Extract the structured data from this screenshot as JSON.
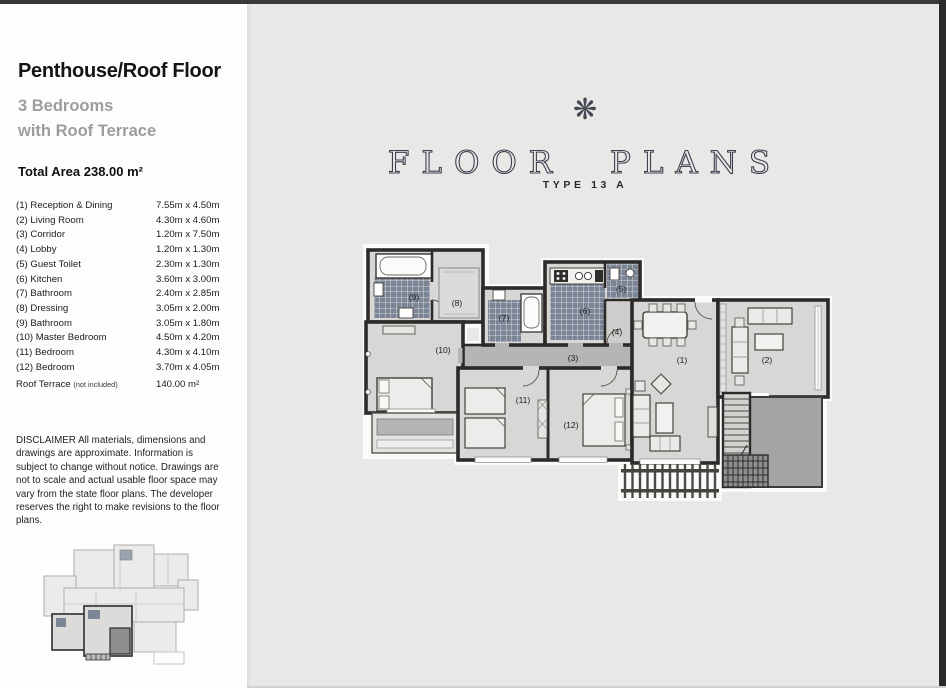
{
  "page": {
    "background": "#e9e8e6",
    "edge_color": "#2b2b2e"
  },
  "sidebar": {
    "title": "Penthouse/Roof Floor",
    "subtitle_line1": "3 Bedrooms",
    "subtitle_line2": "with Roof Terrace",
    "total_area": "Total Area 238.00 m²",
    "rooms": [
      {
        "name": "(1) Reception & Dining",
        "dims": "7.55m x 4.50m"
      },
      {
        "name": "(2) Living Room",
        "dims": "4.30m x 4.60m"
      },
      {
        "name": "(3) Corridor",
        "dims": "1.20m x 7.50m"
      },
      {
        "name": "(4) Lobby",
        "dims": "1.20m x 1.30m"
      },
      {
        "name": "(5) Guest Toilet",
        "dims": "2.30m x 1.30m"
      },
      {
        "name": "(6) Kitchen",
        "dims": "3.60m x 3.00m"
      },
      {
        "name": "(7) Bathroom",
        "dims": "2.40m x 2.85m"
      },
      {
        "name": "(8) Dressing",
        "dims": "3.05m x 2.00m"
      },
      {
        "name": "(9) Bathroom",
        "dims": "3.05m x 1.80m"
      },
      {
        "name": "(10) Master Bedroom",
        "dims": "4.50m x 4.20m"
      },
      {
        "name": "(11) Bedroom",
        "dims": "4.30m x 4.10m"
      },
      {
        "name": "(12) Bedroom",
        "dims": "3.70m x 4.05m"
      }
    ],
    "roof_terrace": {
      "label": "Roof Terrace",
      "note": "(not included)",
      "value": "140.00 m²"
    },
    "disclaimer": "DISCLAIMER All materials, dimensions and drawings are approximate. Information is subject to change without notice. Drawings are not to scale and actual usable floor space may vary from the state floor plans. The developer reserves the right to make revisions to the floor plans."
  },
  "header": {
    "ornament_glyph": "❋",
    "title": "FLOOR PLANS",
    "subtitle": "TYPE 13 A",
    "title_color": "#3d4250"
  },
  "plan": {
    "labels": [
      "(1)",
      "(2)",
      "(3)",
      "(4)",
      "(5)",
      "(6)",
      "(7)",
      "(8)",
      "(9)",
      "(10)",
      "(11)",
      "(12)"
    ],
    "colors": {
      "wall": "#2c2b29",
      "tile": "#7b8595",
      "floor": "#d8d7d5",
      "corridor": "#b6b5b3",
      "roof_terrace": "#a5a4a2"
    }
  }
}
